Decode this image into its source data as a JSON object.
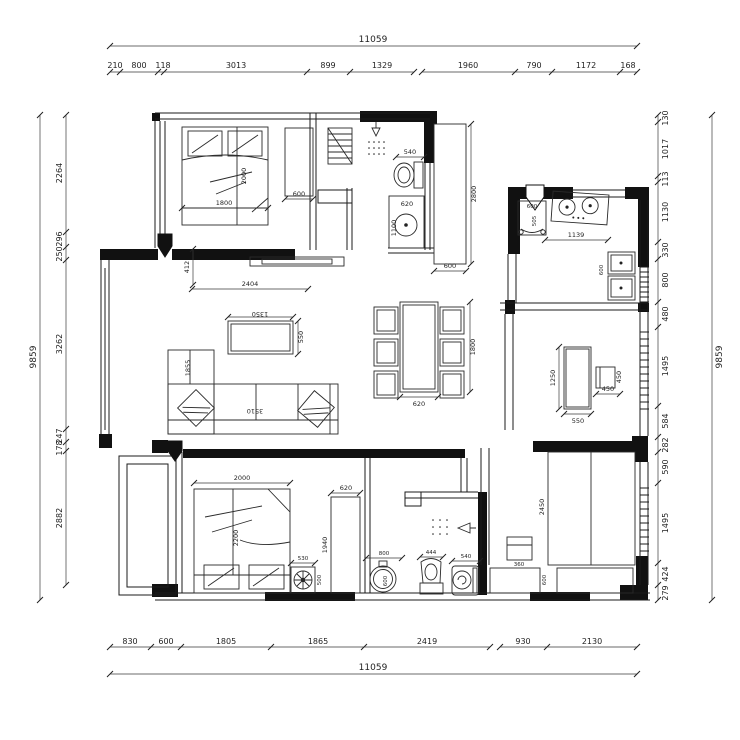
{
  "drawing": {
    "type": "apartment floor plan",
    "units": "mm"
  },
  "dims": {
    "top": {
      "total": "11059",
      "segments": [
        "210",
        "800",
        "118",
        "3013",
        "899",
        "1329",
        "1960",
        "790",
        "1172",
        "168"
      ]
    },
    "bottom": {
      "total": "11059",
      "segments": [
        "830",
        "600",
        "1805",
        "1865",
        "2419",
        "930",
        "2130"
      ]
    },
    "left": {
      "total": "9859",
      "segments": [
        "2264",
        "296",
        "250",
        "3262",
        "247",
        "178",
        "2882"
      ]
    },
    "right": {
      "total": "9859",
      "segments": [
        "130",
        "1017",
        "113",
        "1130",
        "330",
        "800",
        "480",
        "1495",
        "584",
        "282",
        "590",
        "1495",
        "424",
        "279"
      ]
    }
  },
  "labels": {
    "bed1_width": "1800",
    "bed1_length": "2000",
    "wardrobe1_width": "600",
    "closet_length": "2800",
    "closet_width": "600",
    "toilet1_width": "540",
    "washer1_width": "620",
    "washer1_depth": "1100",
    "appliance_width": "600",
    "appliance_depth": "505",
    "kitchen_counter": "1139",
    "sink_depth": "600",
    "tv_offset": "412",
    "tv_wall_width": "2404",
    "coffee_width": "1350",
    "coffee_depth": "550",
    "sofa_width": "3510",
    "sofa_depth": "1855",
    "dining_length": "1800",
    "dining_width": "620",
    "desk_length": "1250",
    "desk_width": "550",
    "chair_width": "450",
    "chair_depth": "450",
    "bed2_width": "2000",
    "bed2_length": "2200",
    "nightstand2_width": "530",
    "nightstand2_depth": "500",
    "wardrobe2_width": "620",
    "wardrobe2_length": "1940",
    "basin_width": "800",
    "basin_depth": "600",
    "toilet2_width": "444",
    "bidet_width": "540",
    "tatami_length": "2450",
    "nightstand3_width": "360",
    "cabinet_depth": "600"
  }
}
